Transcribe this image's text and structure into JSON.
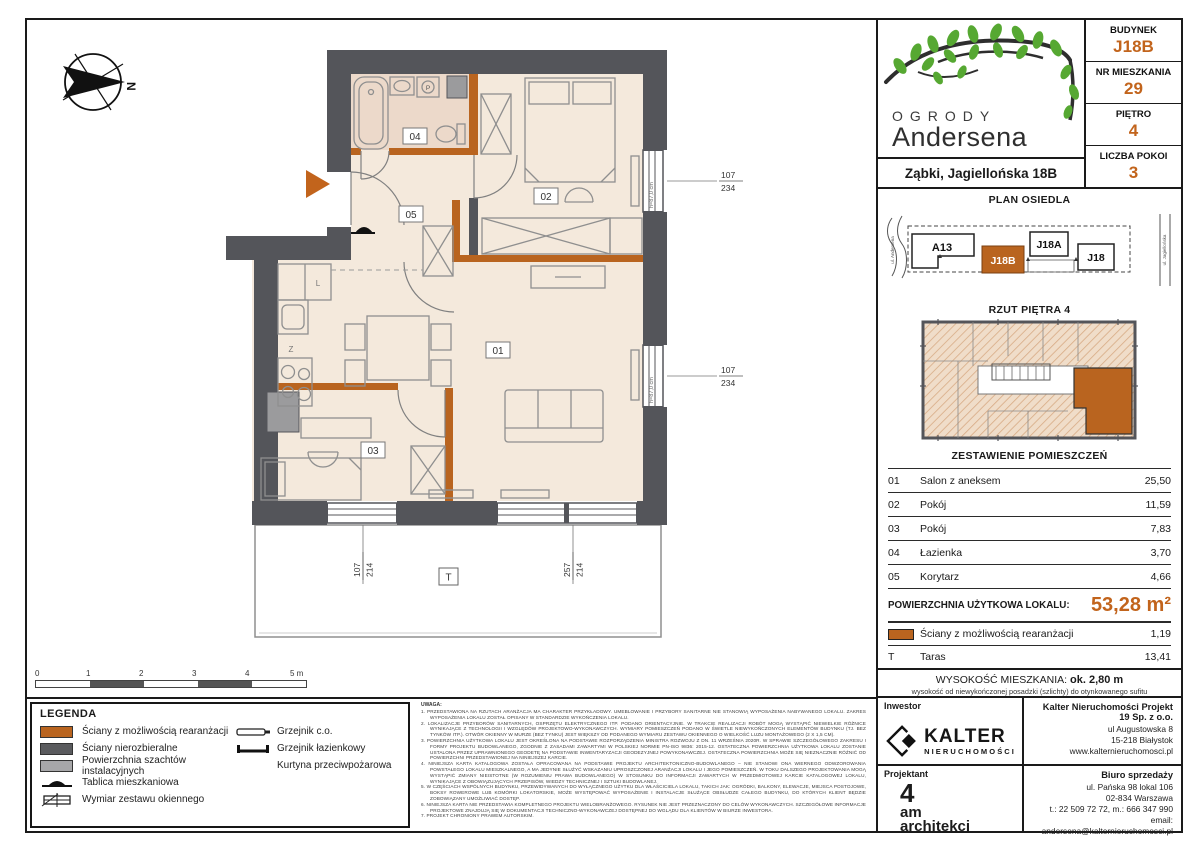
{
  "header": {
    "logo_top": "OGRODY",
    "logo_bottom": "Andersena",
    "address": "Ząbki, Jagiellońska 18B",
    "info": [
      {
        "label": "BUDYNEK",
        "value": "J18B"
      },
      {
        "label": "NR MIESZKANIA",
        "value": "29"
      },
      {
        "label": "PIĘTRO",
        "value": "4"
      },
      {
        "label": "LICZBA POKOI",
        "value": "3"
      }
    ]
  },
  "site_plan": {
    "title": "PLAN OSIEDLA",
    "street_left": "ul. Andersena",
    "street_right": "ul. Jagiellońska",
    "buildings": {
      "a13": "A13",
      "j18b": "J18B",
      "j18a": "J18A",
      "j18": "J18"
    }
  },
  "floor_thumb": {
    "title": "RZUT PIĘTRA 4"
  },
  "rooms_table": {
    "title": "ZESTAWIENIE POMIESZCZEŃ",
    "rows": [
      {
        "no": "01",
        "name": "Salon z aneksem",
        "area": "25,50"
      },
      {
        "no": "02",
        "name": "Pokój",
        "area": "11,59"
      },
      {
        "no": "03",
        "name": "Pokój",
        "area": "7,83"
      },
      {
        "no": "04",
        "name": "Łazienka",
        "area": "3,70"
      },
      {
        "no": "05",
        "name": "Korytarz",
        "area": "4,66"
      }
    ],
    "total_label": "POWIERZCHNIA UŻYTKOWA LOKALU:",
    "total_value": "53,28 m²",
    "walls_row": {
      "name": "Ściany z możliwością rearanżacji",
      "area": "1,19"
    },
    "terrace_row": {
      "no": "T",
      "name": "Taras",
      "area": "13,41"
    }
  },
  "height_info": {
    "label": "WYSOKOŚĆ MIESZKANIA:",
    "value": "ok. 2,80 m",
    "note": "wysokość od niewykończonej posadzki (szlichty) do otynkowanego sufitu"
  },
  "legend": {
    "title": "LEGENDA",
    "col1": [
      "Ściany z możliwością rearanżacji",
      "Ściany nierozbieralne",
      "Powierzchnia szachtów instalacyjnych",
      "Tablica mieszkaniowa",
      "Wymiar zestawu okiennego"
    ],
    "col2": [
      "Grzejnik c.o.",
      "Grzejnik łazienkowy",
      "Kurtyna przeciwpożarowa"
    ]
  },
  "scale_bar": {
    "labels": [
      "0",
      "1",
      "2",
      "3",
      "4",
      "5 m"
    ]
  },
  "notes": {
    "title": "UWAGA:",
    "items": [
      "1.  PRZEDSTAWIONA NA RZUTACH ARANŻACJA MA CHARAKTER PRZYKŁADOWY. UMEBLOWANIE I PRZYBORY SANITARNE NIE STANOWIĄ WYPOSAŻENIA NABYWANEGO LOKALU. ZAKRES WYPOSAŻENIA LOKALU ZOSTAŁ OPISANY W STANDARDZIE WYKOŃCZENIA LOKALU.",
      "2.  LOKALIZACJE PRZYBORÓW SANITARNYCH, OSPRZĘTU ELEKTRYCZNEGO ITP. PODANO ORIENTACYJNIE. W TRAKCIE REALIZACJI ROBÓT MOGĄ WYSTĄPIĆ NIEWIELKIE RÓŻNICE WYNIKAJĄCE Z TECHNOLOGII I WZGLĘDÓW PROJEKTOWO-WYKONAWCZYCH. WYMIARY POMIESZCZEŃ PODANO W ŚWIETLE NIEWYKOŃCZONYCH ELEMENTÓW BUDYNKU (TJ. BEZ TYNKÓW ITP.). OTWÓR OKIENNY W MURZE (BEZ TYNKU) JEST WIĘKSZY OD PODANEGO WYMIARU ZESTAWU OKIENNEGO O WIELKOŚĆ LUZU MONTAŻOWEGO (2 X 1,5 CM).",
      "3.  POWIERZCHNIA UŻYTKOWA LOKALU JEST OKREŚLONA NA PODSTAWIE ROZPORZĄDZENIA MINISTRA ROZWOJU Z DN. 11 WRZEŚNIA 2020R. W SPRAWIE SZCZEGÓŁOWEGO ZAKRESU I FORMY PROJEKTU BUDOWLANEGO, ZGODNIE Z ZASADAMI ZAWARTYMI W POLSKIEJ NORMIE PN-ISO 9836: 2015-12. OSTATECZNA POWIERZCHNIA UŻYTKOWA LOKALU ZOSTANIE USTALONA PRZEZ UPRAWNIONEGO GEODETĘ NA PODSTAWIE INWENTARYZACJI GEODEZYJNEJ POWYKONAWCZEJ. OSTATECZNA POWIERZCHNIA MOŻE SIĘ NIEZNACZNIE RÓŻNIĆ OD POWIERZCHNI PRZEDSTAWIONEJ NA NINIEJSZEJ KARCIE.",
      "4.  NINIEJSZA KARTA KATALOGOWA ZOSTAŁA OPRACOWANA NA PODSTAWIE PROJEKTU ARCHITEKTONICZNO-BUDOWLANEGO – NIE STANOWI ONA WIERNEGO ODWZOROWANIA POWSTAŁEGO LOKALU MIESZKALNEGO, A MA JEDYNIE SŁUŻYĆ WSKAZANIU UPROSZCZONEJ ARANŻACJI LOKALU I JEGO POMIESZCZEŃ. W TOKU DALSZEGO PROJEKTOWANIA MOGĄ WYSTĄPIĆ ZMIANY NIEISTOTNE (W ROZUMIENIU PRAWA BUDOWLANEGO) W STOSUNKU DO INFORMACJI ZAWARTYCH W PRZEDMIOTOWEJ KARCIE KATALOGOWEJ LOKALU, WYNIKAJĄCE Z OBOWIĄZUJĄCYCH PRZEPISÓW, WIEDZY TECHNICZNEJ I SZTUKI BUDOWLANEJ.",
      "5.  W CZĘŚCIACH WSPÓLNYCH BUDYNKU, PRZEWIDYWANYCH DO WYŁĄCZNEGO UŻYTKU DLA WŁAŚCICIELA LOKALU, TAKICH JAK: OGRÓDKI, BALKONY, ELEWACJE, MIEJSCA POSTOJOWE, BOKSY ROWEROWE LUB KOMÓRKI LOKATORSKIE, MOŻE WYSTĘPOWAĆ WYPOSAŻENIE I INSTALACJE SŁUŻĄCE OBSŁUDZE CAŁEGO BUDYNKU, DO KTÓRYCH KLIENT BĘDZIE ZOBOWIĄZANY UMOŻLIWIAĆ DOSTĘP.",
      "6.  NINIEJSZA KARTA NIE PRZEDSTAWIA KOMPLETNEGO PROJEKTU WIELOBRANŻOWEGO. RYSUNEK NIE JEST PRZEZNACZONY DO CELÓW WYKONAWCZYCH. SZCZEGÓŁOWE INFORMACJE PROJEKTOWE ZNAJDUJĄ SIĘ W DOKUMENTACJI TECHNICZNO-WYKONAWCZEJ DOSTĘPNEJ DO WGLĄDU DLA KLIENTÓW W BIURZE INWESTORA.",
      "7.  PROJEKT CHRONIONY PRAWEM AUTORSKIM."
    ]
  },
  "title_block": {
    "investor_label": "Inwestor",
    "investor_logo_name": "KALTER",
    "investor_logo_sub": "NIERUCHOMOŚCI",
    "company_name": "Kalter Nieruchomości Projekt 19 Sp. z o.o.",
    "company_address": [
      "ul Augustowska 8",
      "15-218 Białystok",
      "www.kalternieruchomosci.pl"
    ],
    "designer_label": "Projektant",
    "designer_line1": "4",
    "designer_line2": "am",
    "designer_line3": "architekci",
    "sales_label": "Biuro sprzedaży",
    "sales_address": [
      "ul. Pańska 98 lokal 106",
      "02-834 Warszawa",
      "t.: 22 509 72 72, m.: 666 347 990",
      "email: andersena@kalternieruchomosci.pl"
    ]
  },
  "plan": {
    "compass": "N",
    "room_labels": {
      "r01": "01",
      "r02": "02",
      "r03": "03",
      "r04": "04",
      "r05": "05",
      "terrace": "T"
    },
    "kitchen": {
      "fridge": "L",
      "dishwasher": "Z",
      "washer": "P"
    },
    "dims": {
      "win_right1_w": "107",
      "win_right1_h": "234",
      "win_right2_w": "107",
      "win_right2_h": "234",
      "win_bottom1_w": "107",
      "win_bottom1_h": "214",
      "win_bottom2_w": "257",
      "win_bottom2_h": "214",
      "sill_height": "h=87,0 cm"
    }
  }
}
